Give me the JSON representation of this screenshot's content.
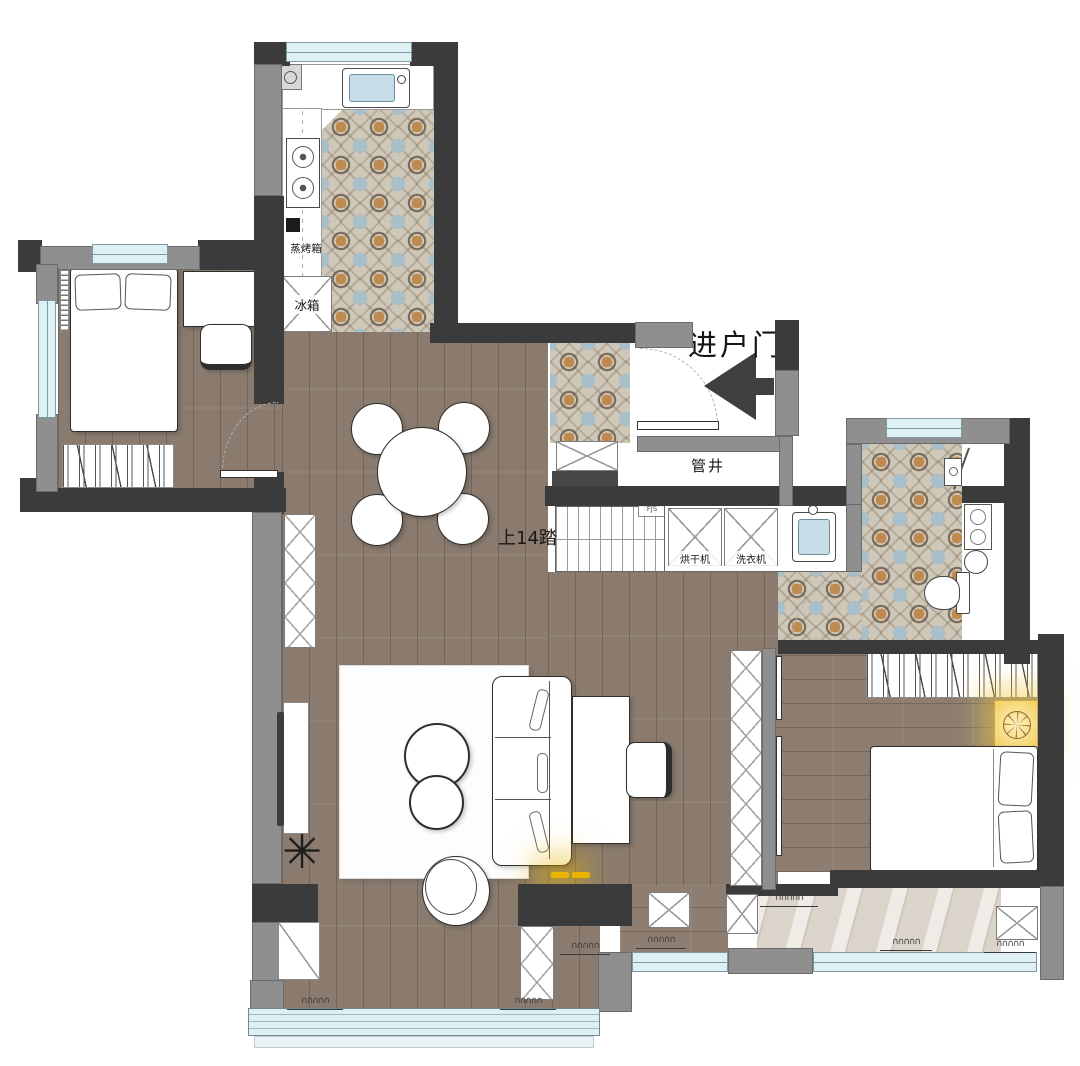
{
  "plan": {
    "title": "apartment-floor-plan",
    "labels": {
      "entry_door": "进户门",
      "pipe_shaft": "管井",
      "stairs_up": "上14踏",
      "dryer": "烘干机",
      "washer": "洗衣机",
      "steam_oven": "蒸烤箱",
      "fridge": "冰箱",
      "manifold": "FJS"
    },
    "icons": {
      "stair_chevron": ">",
      "curtain": "∩∩∩∩∩",
      "plant": "✳",
      "entry_arrow": "left-pointing-triangle"
    },
    "colors": {
      "wall_dark": "#3b3b3b",
      "wall_gray": "#8f8f8f",
      "wood_floor": "#8a7b6e",
      "tile_base": "#cfc7b8",
      "marble_floor": "#dbd4ca",
      "window_glass": "#dff0f4",
      "lamp_glow": "#e8b400"
    }
  }
}
